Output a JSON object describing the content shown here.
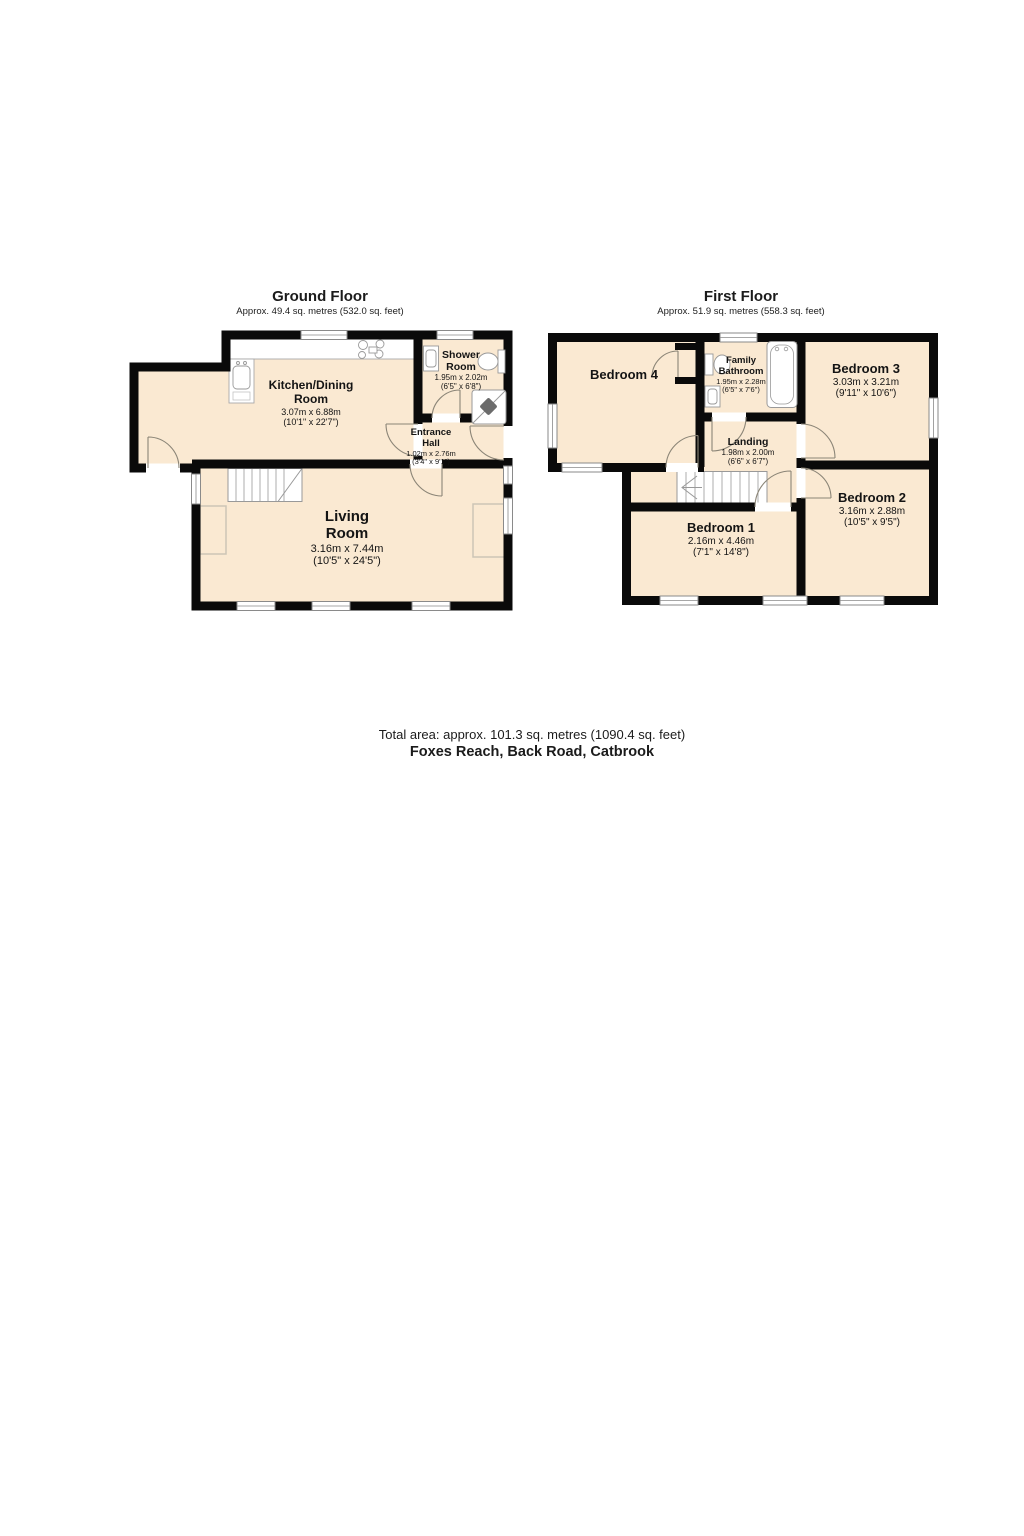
{
  "ground_floor": {
    "title": "Ground Floor",
    "subtitle": "Approx. 49.4 sq. metres (532.0 sq. feet)",
    "rooms": {
      "kitchen": {
        "lines": [
          "Kitchen/Dining",
          "Room"
        ],
        "dims_m": "3.07m x 6.88m",
        "dims_ft": "(10'1\" x 22'7\")"
      },
      "shower": {
        "lines": [
          "Shower",
          "Room"
        ],
        "dims_m": "1.95m x 2.02m",
        "dims_ft": "(6'5\" x 6'8\")"
      },
      "hall": {
        "lines": [
          "Entrance",
          "Hall"
        ],
        "dims_m": "1.02m x 2.76m",
        "dims_ft": "(3'4\" x 9'1\")"
      },
      "living": {
        "lines": [
          "Living",
          "Room"
        ],
        "dims_m": "3.16m x 7.44m",
        "dims_ft": "(10'5\" x 24'5\")"
      }
    }
  },
  "first_floor": {
    "title": "First Floor",
    "subtitle": "Approx. 51.9 sq. metres (558.3 sq. feet)",
    "rooms": {
      "bedroom4": {
        "lines": [
          "Bedroom 4"
        ]
      },
      "bathroom": {
        "lines": [
          "Family",
          "Bathroom"
        ],
        "dims_m": "1.95m x 2.28m",
        "dims_ft": "(6'5\" x 7'6\")"
      },
      "bedroom3": {
        "lines": [
          "Bedroom 3"
        ],
        "dims_m": "3.03m x 3.21m",
        "dims_ft": "(9'11\" x 10'6\")"
      },
      "landing": {
        "lines": [
          "Landing"
        ],
        "dims_m": "1.98m x 2.00m",
        "dims_ft": "(6'6\" x 6'7\")"
      },
      "bedroom1": {
        "lines": [
          "Bedroom 1"
        ],
        "dims_m": "2.16m x 4.46m",
        "dims_ft": "(7'1\" x 14'8\")"
      },
      "bedroom2": {
        "lines": [
          "Bedroom 2"
        ],
        "dims_m": "3.16m x 2.88m",
        "dims_ft": "(10'5\" x 9'5\")"
      }
    }
  },
  "footer": {
    "total_area": "Total area: approx. 101.3 sq. metres (1090.4 sq. feet)",
    "address": "Foxes Reach, Back Road, Catbrook"
  },
  "colors": {
    "floor_fill": "#FAE9D2",
    "wall": "#0A0A0A",
    "fixture_stroke": "#999999"
  }
}
